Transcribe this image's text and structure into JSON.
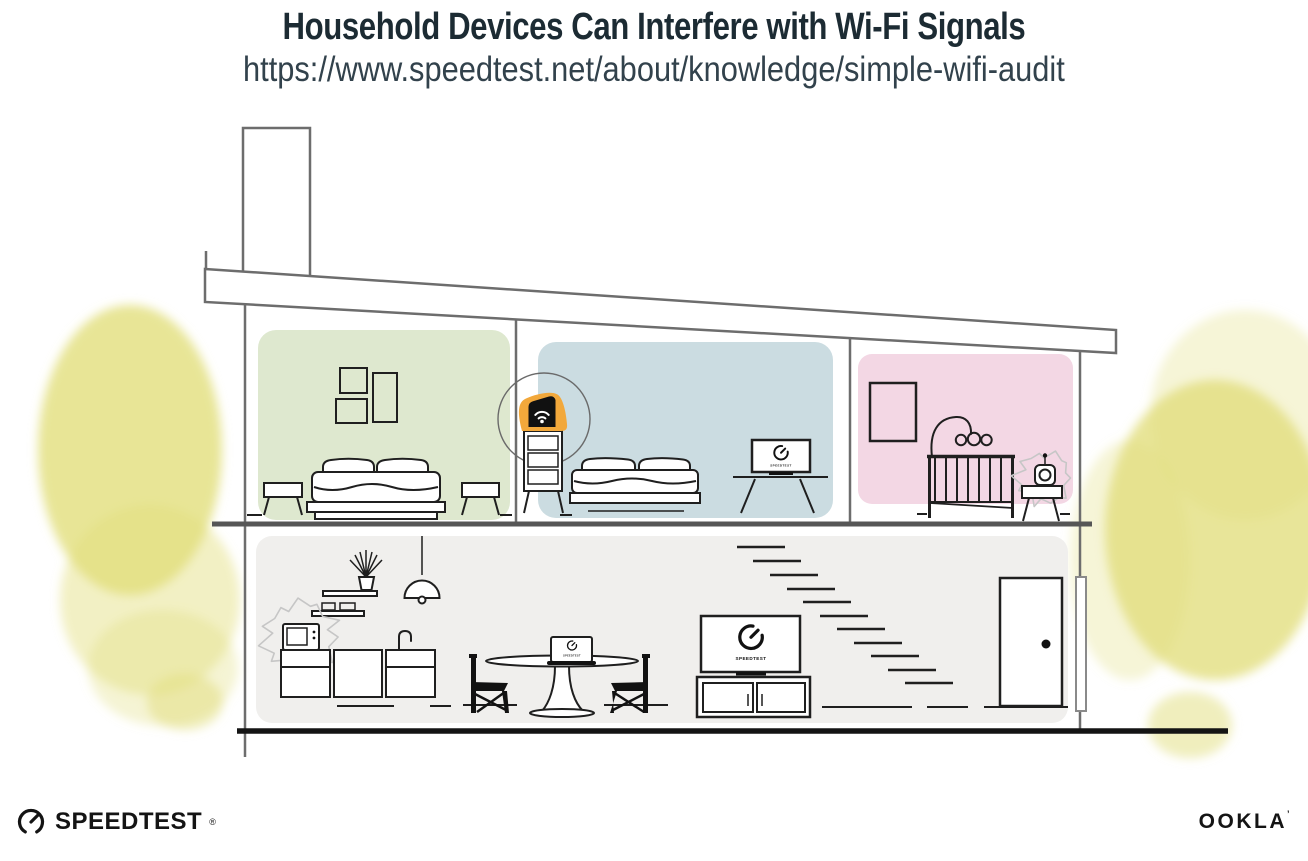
{
  "header": {
    "title": "Household Devices Can Interfere with Wi-Fi Signals",
    "url": "https://www.speedtest.net/about/knowledge/simple-wifi-audit"
  },
  "screens": {
    "label": "SPEEDTEST"
  },
  "footer": {
    "speedtest": "SPEEDTEST",
    "speedtest_mark": "®",
    "ookla": "OOKLA",
    "ookla_mark": "’"
  },
  "colors": {
    "accent_orange": "#F2A83B",
    "room_green": "#DEE8CF",
    "room_blue": "#CBDCE1",
    "room_pink": "#F3D7E4",
    "floor_gray": "#F0EFED",
    "tree_yellow": "#E2DE7C",
    "structure_gray": "#6D6D6D",
    "ink": "#1F1F1F",
    "title_text": "#1C2B33",
    "url_text": "#32424C"
  }
}
